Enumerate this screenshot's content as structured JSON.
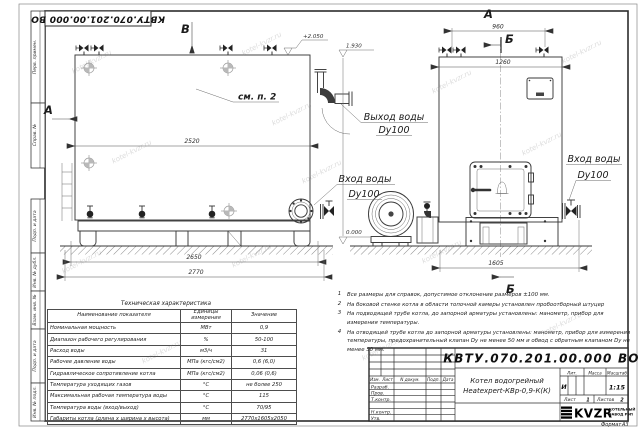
{
  "watermark": "kotel-kvzr.ru",
  "stamp_top": "КВТУ.070.201.00.000  ВО",
  "margin": {
    "top_cells": [
      "Перв. примен.",
      "Справ. №"
    ],
    "bottom_cells": [
      "Подп. и дата",
      "Инв. № дубл.",
      "Взам. инв. №",
      "Подп. и дата",
      "Инв. № подл."
    ]
  },
  "views": {
    "front_top_label": "В",
    "front_left_label": "А",
    "side_top_label": "А",
    "section_top": "Б",
    "section_bottom": "Б",
    "see_note": "см. п. 2"
  },
  "dims": {
    "d2520": "2520",
    "d2650": "2650",
    "d2770": "2770",
    "d960": "960",
    "d1260": "1260",
    "d1605": "1605"
  },
  "elevations": {
    "top": "+2.050",
    "outlet": "1.930",
    "ground": "0.000"
  },
  "callouts": {
    "outlet": {
      "line1": "Выход воды",
      "line2": "Dy100"
    },
    "inlet_front": {
      "line1": "Вход воды",
      "line2": "Dy100"
    },
    "inlet_side": {
      "line1": "Вход воды",
      "line2": "Dy100"
    }
  },
  "tech_table": {
    "title": "Техническая характеристика",
    "headers": [
      "Наименование показателя",
      "Единицы измерения",
      "Значение"
    ],
    "rows": [
      {
        "name": "Номинальная мощность",
        "unit": "МВт",
        "value": "0,9"
      },
      {
        "name": "Диапазон рабочего регулирования",
        "unit": "%",
        "value": "50-100"
      },
      {
        "name": "Расход воды",
        "unit": "м3/ч",
        "value": "31"
      },
      {
        "name": "Рабочее давление воды",
        "unit": "МПа (кгс/см2)",
        "value": "0,6 (6,0)"
      },
      {
        "name": "Гидравлическое сопротивление котла",
        "unit": "МПа (кгс/см2)",
        "value": "0,06 (0,6)"
      },
      {
        "name": "Температура уходящих газов",
        "unit": "°С",
        "value": "не более 250"
      },
      {
        "name": "Максимальная рабочая температура воды",
        "unit": "°С",
        "value": "115"
      },
      {
        "name": "Температура воды (вход/выход)",
        "unit": "°С",
        "value": "70/95"
      },
      {
        "name": "Габариты котла (длина х ширина х высота)",
        "unit": "мм",
        "value": "2770х1605х2050"
      }
    ]
  },
  "notes": [
    {
      "num": "1",
      "text": "Все размеры для справок, допустимое отклонение размеров ±100 мм."
    },
    {
      "num": "2",
      "text": "На боковой стенке котла в области топочной камеры установлен пробоотборный штуцер"
    },
    {
      "num": "3",
      "text": "На подводящей трубе котла, до запорной арматуры установлены: манометр, прибор для измерения температуры."
    },
    {
      "num": "4",
      "text": "На отводящей трубе котла до запорной арматуры установлены: манометр, прибор для измерения температуры, предохранительный клапан Dy не менее 50 мм и обвод с обратным клапаном Dy не менее 50 мм."
    }
  ],
  "title_block": {
    "doc_number": "КВТУ.070.201.00.000  ВО",
    "product_line1": "Котел водогрейный",
    "product_line2": "Heatexpert-КВр-0,9-К(К)",
    "rev_headers": [
      "Изм.",
      "Лист",
      "N докум.",
      "Подп.",
      "Дата"
    ],
    "rev_rows": [
      "Разраб.",
      "Пров.",
      "Т.контр.",
      "",
      "Н.контр.",
      "Утв."
    ],
    "lit_label": "Лит.",
    "lit_value": "И",
    "mass_label": "Масса",
    "scale_label": "Масштаб",
    "scale_value": "1:15",
    "sheet_label": "Лист",
    "sheet_value": "1",
    "sheets_label": "Листов",
    "sheets_value": "2",
    "logo_text": "KVZR",
    "logo_sub1": "КОТЕЛЬНЫЙ",
    "logo_sub2": "ЗАВОД РЭП",
    "format_label": "Формат",
    "format_value": "А3"
  }
}
